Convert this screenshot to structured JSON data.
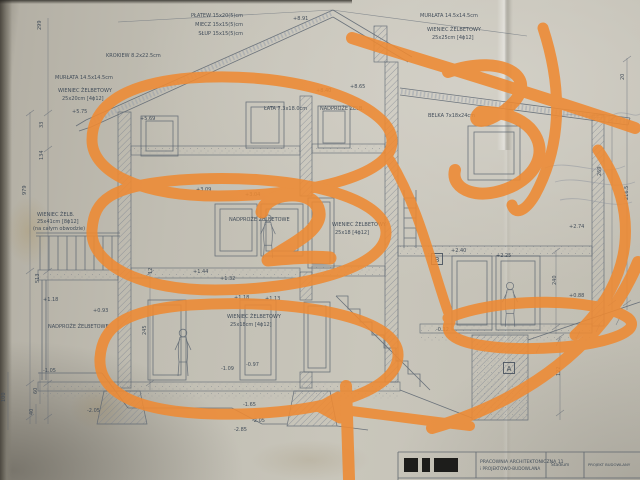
{
  "meta": {
    "description": "Photograph of an architectural cross-section blueprint (Polish) annotated with thick orange marker",
    "paper_color": "#c3c0b5",
    "ink_color": "#5a6470",
    "marker_color": "#ee8a33"
  },
  "annotations": {
    "marker_color": "#ee8a33",
    "handwritten_digits": [
      "2",
      "3"
    ],
    "shapes": [
      "ellipse around attic storey",
      "ellipse around first-floor storey",
      "ellipse around ground-floor storey",
      "large handwritten digit 2 over first floor",
      "scribbled digit 3 over right roof",
      "diagonal slash across right roof",
      "curved stroke down right edge",
      "loop around right-wing ground floor",
      "long left-pointing arrow at bottom",
      "vertical stroke at bottom centre",
      "curl sweeping from bottom-right corner"
    ]
  },
  "labels": [
    {
      "t": "PŁATEW 15x20(5)cm",
      "x": 243,
      "y": 17,
      "a": "end"
    },
    {
      "t": "MIECZ 15x15(5)cm",
      "x": 243,
      "y": 26,
      "a": "end"
    },
    {
      "t": "SŁUP 15x15(5)cm",
      "x": 243,
      "y": 35,
      "a": "end"
    },
    {
      "t": "+8.91",
      "x": 293,
      "y": 20
    },
    {
      "t": "MURŁATA 14.5x14.5cm",
      "x": 420,
      "y": 17
    },
    {
      "t": "WIENIEC ŻELBETOWY",
      "x": 427,
      "y": 31
    },
    {
      "t": "25x25cm [4ϕ12]",
      "x": 432,
      "y": 39
    },
    {
      "t": "KROKIEW 8.2x22.5cm",
      "x": 106,
      "y": 57
    },
    {
      "t": "MURŁATA 14.5x14.5cm",
      "x": 55,
      "y": 79
    },
    {
      "t": "WIENIEC ŻELBETOWY",
      "x": 58,
      "y": 92
    },
    {
      "t": "25x20cm [4ϕ12]",
      "x": 62,
      "y": 100
    },
    {
      "t": "+5.75",
      "x": 72,
      "y": 113
    },
    {
      "t": "+5.69",
      "x": 140,
      "y": 120
    },
    {
      "t": "+8.40",
      "x": 316,
      "y": 92
    },
    {
      "t": "+8.65",
      "x": 350,
      "y": 88
    },
    {
      "t": "ŁATA 7.3x18.0cm",
      "x": 264,
      "y": 110
    },
    {
      "t": "NADPROŻE ŻELB.",
      "x": 320,
      "y": 110
    },
    {
      "t": "BELKA 7x18x24cm",
      "x": 428,
      "y": 117
    },
    {
      "t": "+3.09",
      "x": 196,
      "y": 191
    },
    {
      "t": "+3.04",
      "x": 245,
      "y": 196
    },
    {
      "t": "NADPROŻE ŻELBETOWE",
      "x": 229,
      "y": 221
    },
    {
      "t": "WIENIEC ŻELBETOWY",
      "x": 332,
      "y": 226
    },
    {
      "t": "25x18 [4ϕ12]",
      "x": 335,
      "y": 234
    },
    {
      "t": "WIENIEC ŻELB.",
      "x": 37,
      "y": 216
    },
    {
      "t": "25x41cm [8ϕ12]",
      "x": 37,
      "y": 223
    },
    {
      "t": "(na całym obwodzie)",
      "x": 33,
      "y": 230
    },
    {
      "t": "+2.40",
      "x": 451,
      "y": 252
    },
    {
      "t": "+2.25",
      "x": 496,
      "y": 257
    },
    {
      "t": "+2.74",
      "x": 569,
      "y": 228
    },
    {
      "t": "+0.88",
      "x": 569,
      "y": 297
    },
    {
      "t": "+1.44",
      "x": 193,
      "y": 273
    },
    {
      "t": "+1.32",
      "x": 220,
      "y": 280
    },
    {
      "t": "+1.18",
      "x": 234,
      "y": 299
    },
    {
      "t": "+1.13",
      "x": 265,
      "y": 300
    },
    {
      "t": "WIENIEC ŻELBETOWY",
      "x": 227,
      "y": 318
    },
    {
      "t": "25x18cm [4ϕ12]",
      "x": 230,
      "y": 326
    },
    {
      "t": "+1.18",
      "x": 43,
      "y": 301
    },
    {
      "t": "+0.93",
      "x": 93,
      "y": 312
    },
    {
      "t": "NADPROŻE ŻELBETOWE",
      "x": 48,
      "y": 328
    },
    {
      "t": "-1.09",
      "x": 221,
      "y": 370
    },
    {
      "t": "-0.97",
      "x": 246,
      "y": 366
    },
    {
      "t": "-1.65",
      "x": 243,
      "y": 406
    },
    {
      "t": "-2.05",
      "x": 252,
      "y": 422
    },
    {
      "t": "-1.05",
      "x": 43,
      "y": 372
    },
    {
      "t": "-2.05",
      "x": 87,
      "y": 412
    },
    {
      "t": "-2.85",
      "x": 234,
      "y": 431
    },
    {
      "t": "-0.12",
      "x": 436,
      "y": 331
    },
    {
      "t": "B",
      "x": 437,
      "y": 262,
      "box": true,
      "s": 7,
      "a": "middle"
    },
    {
      "t": "A",
      "x": 509,
      "y": 371,
      "box": true,
      "s": 7,
      "a": "middle"
    },
    {
      "t": "299",
      "x": 41,
      "y": 30,
      "r": -90
    },
    {
      "t": "33",
      "x": 43,
      "y": 128,
      "r": -90
    },
    {
      "t": "134",
      "x": 43,
      "y": 160,
      "r": -90
    },
    {
      "t": "979",
      "x": 26,
      "y": 195,
      "r": -90
    },
    {
      "t": "513",
      "x": 39,
      "y": 283,
      "r": -90
    },
    {
      "t": "245",
      "x": 146,
      "y": 335,
      "r": -90
    },
    {
      "t": "12",
      "x": 152,
      "y": 274,
      "r": -90
    },
    {
      "t": "20",
      "x": 624,
      "y": 80,
      "r": -90
    },
    {
      "t": "269",
      "x": 601,
      "y": 176,
      "r": -90
    },
    {
      "t": "216.5",
      "x": 628,
      "y": 200,
      "r": -90
    },
    {
      "t": "240",
      "x": 556,
      "y": 285,
      "r": -90
    },
    {
      "t": "122",
      "x": 560,
      "y": 376,
      "r": -90
    },
    {
      "t": "100",
      "x": 5,
      "y": 402,
      "r": -90
    },
    {
      "t": "60",
      "x": 37,
      "y": 394,
      "r": -90
    },
    {
      "t": "40",
      "x": 33,
      "y": 415,
      "r": -90
    }
  ],
  "title_block": {
    "firm": "PRACOWNIA ARCHITEKTONICZNA 11",
    "firm2": "i PROJEKTOWO-BUDOWLANA",
    "stadium_label": "Stadium",
    "project_label": "PROJEKT BUDOWLANY"
  }
}
